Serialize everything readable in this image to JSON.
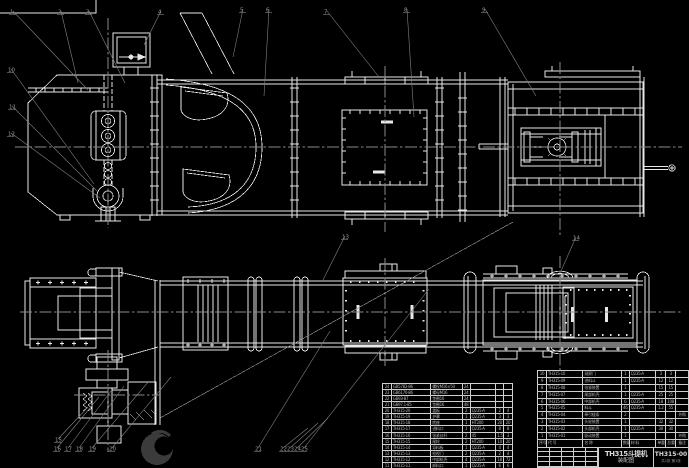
{
  "drawing": {
    "title_line1": "TH315斗提机",
    "title_line2": "装配图",
    "drawing_number": "TH315-00",
    "sheet_note": "共1张 第1张"
  },
  "colors": {
    "background": "#000000",
    "line": "#e8e8e8",
    "leader": "#828282",
    "label": "#9a9a9a",
    "table_line": "#cfcfcf",
    "table_text": "#b5b5b5",
    "watermark": "#3b3b3b"
  },
  "bom_right": {
    "headers": [
      "序号",
      "代  号",
      "名  称",
      "数量",
      "材  料",
      "单重",
      "总重",
      "备注"
    ],
    "rows": [
      [
        "10",
        "TH315-10",
        "观察门",
        "1",
        "Q235-A",
        "3",
        "3",
        ""
      ],
      [
        "9",
        "TH315-09",
        "进料斗",
        "1",
        "Q235-A",
        "12",
        "12",
        ""
      ],
      [
        "8",
        "TH315-08",
        "张紧装置",
        "1",
        "",
        "15",
        "15",
        ""
      ],
      [
        "7",
        "TH315-07",
        "尾部机壳",
        "1",
        "Q235-A",
        "25",
        "25",
        ""
      ],
      [
        "6",
        "TH315-06",
        "中部机壳",
        "6",
        "Q235-A",
        "18",
        "108",
        ""
      ],
      [
        "5",
        "TH315-05",
        "料斗",
        "46",
        "Q235-A",
        "1.2",
        "55",
        ""
      ],
      [
        "4",
        "TH315-04",
        "牵引链条",
        "2",
        "",
        "",
        "",
        "外购"
      ],
      [
        "3",
        "TH315-03",
        "头轮装置",
        "1",
        "",
        "32",
        "32",
        ""
      ],
      [
        "2",
        "TH315-02",
        "头部机壳",
        "1",
        "Q235-A",
        "30",
        "30",
        ""
      ],
      [
        "1",
        "TH315-01",
        "驱动装置",
        "1",
        "",
        "",
        "",
        "外购"
      ]
    ]
  },
  "bom_left": {
    "rows": [
      [
        "24",
        "GB5782-86",
        "螺栓M16×50",
        "24",
        "",
        "",
        ""
      ],
      [
        "23",
        "GB6170-86",
        "螺母M16",
        "24",
        "",
        "",
        ""
      ],
      [
        "22",
        "GB93-87",
        "垫圈16",
        "24",
        "",
        "",
        ""
      ],
      [
        "21",
        "GB97.1-85",
        "垫圈16",
        "48",
        "",
        "",
        ""
      ],
      [
        "20",
        "TH315-20",
        "盖板",
        "2",
        "Q235-A",
        "2",
        "4"
      ],
      [
        "19",
        "TH315-19",
        "护罩",
        "1",
        "Q235-A",
        "3",
        "3"
      ],
      [
        "18",
        "TH315-18",
        "底座",
        "1",
        "HT200",
        "20",
        "20"
      ],
      [
        "17",
        "TH315-17",
        "进料口",
        "1",
        "Q235-A",
        "8",
        "8"
      ],
      [
        "16",
        "TH315-16",
        "张紧丝杆",
        "2",
        "45",
        "1.5",
        "3"
      ],
      [
        "15",
        "TH315-15",
        "尾轮",
        "2",
        "HT200",
        "10",
        "20"
      ],
      [
        "14",
        "TH315-14",
        "导料板",
        "1",
        "Q235-A",
        "4",
        "4"
      ],
      [
        "13",
        "TH315-13",
        "检视门",
        "2",
        "Q235-A",
        "2",
        "4"
      ],
      [
        "12",
        "TH315-12",
        "中部机壳",
        "4",
        "Q235-A",
        "18",
        "72"
      ],
      [
        "11",
        "TH315-11",
        "卸料口",
        "1",
        "Q235-A",
        "6",
        "6"
      ]
    ]
  },
  "callouts": [
    {
      "label": "1",
      "x": 10,
      "y": 9,
      "ex": 88,
      "ey": 90
    },
    {
      "label": "2",
      "x": 58,
      "y": 9,
      "ex": 78,
      "ey": 83
    },
    {
      "label": "3",
      "x": 86,
      "y": 9,
      "ex": 125,
      "ey": 83
    },
    {
      "label": "4",
      "x": 158,
      "y": 9,
      "ex": 144,
      "ey": 45
    },
    {
      "label": "5",
      "x": 240,
      "y": 7,
      "ex": 233,
      "ey": 57
    },
    {
      "label": "6",
      "x": 266,
      "y": 7,
      "ex": 264,
      "ey": 96
    },
    {
      "label": "7",
      "x": 324,
      "y": 9,
      "ex": 379,
      "ey": 77
    },
    {
      "label": "8",
      "x": 404,
      "y": 7,
      "ex": 414,
      "ey": 117
    },
    {
      "label": "9",
      "x": 482,
      "y": 7,
      "ex": 536,
      "ey": 96
    },
    {
      "label": "10",
      "x": 8,
      "y": 67,
      "ex": 94,
      "ey": 184
    },
    {
      "label": "11",
      "x": 9,
      "y": 104,
      "ex": 97,
      "ey": 191
    },
    {
      "label": "12",
      "x": 8,
      "y": 131,
      "ex": 100,
      "ey": 198
    },
    {
      "label": "13",
      "x": 342,
      "y": 234,
      "ex": 322,
      "ey": 282
    },
    {
      "label": "14",
      "x": 573,
      "y": 235,
      "ex": 561,
      "ey": 271
    },
    {
      "label": "15",
      "x": 55,
      "y": 437,
      "ex": 88,
      "ey": 407
    },
    {
      "label": "16",
      "x": 54,
      "y": 446,
      "ex": 99,
      "ey": 397
    },
    {
      "label": "17",
      "x": 65,
      "y": 446,
      "ex": 111,
      "ey": 391
    },
    {
      "label": "18",
      "x": 76,
      "y": 446,
      "ex": 124,
      "ey": 386
    },
    {
      "label": "19",
      "x": 89,
      "y": 446,
      "ex": 149,
      "ey": 381
    },
    {
      "label": "20",
      "x": 109,
      "y": 446,
      "ex": 171,
      "ey": 377
    },
    {
      "label": "21",
      "x": 255,
      "y": 446,
      "ex": 330,
      "ey": 331
    },
    {
      "label": "22",
      "x": 280,
      "y": 446,
      "ex": 308,
      "ey": 428
    },
    {
      "label": "23",
      "x": 287,
      "y": 446,
      "ex": 318,
      "ey": 423
    },
    {
      "label": "24",
      "x": 294,
      "y": 446,
      "ex": 328,
      "ey": 418
    },
    {
      "label": "25",
      "x": 301,
      "y": 446,
      "ex": 429,
      "ey": 289
    }
  ]
}
